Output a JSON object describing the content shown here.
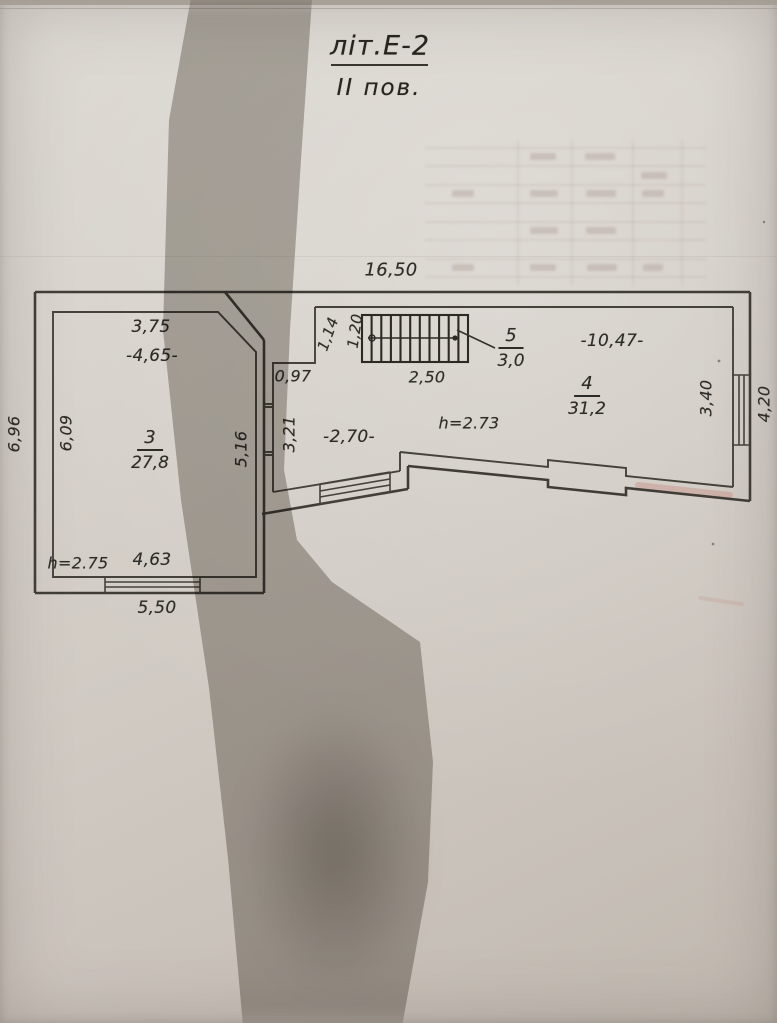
{
  "title": {
    "building_label": "літ.Е-2",
    "floor_label": "ІІ пов."
  },
  "plan": {
    "rooms": [
      {
        "number": "3",
        "area": "27,8",
        "height": "h=2.75"
      },
      {
        "number": "4",
        "area": "31,2",
        "height": "h=2.73"
      },
      {
        "number": "5",
        "area": "3,0"
      }
    ],
    "dims": {
      "total_width": "16,50",
      "room3_top": "3,75",
      "room3_top_inner": "-4,65-",
      "left_outer": "6,96",
      "left_inner": "6,09",
      "room3_right": "5,16",
      "corridor_left": "3,21",
      "corridor_step": "0,97",
      "stair_step": "1,14",
      "stair_width": "1,20",
      "stair_length": "2,50",
      "corridor_width": "-2,70-",
      "room4_length": "-10,47-",
      "room4_right": "3,40",
      "right_outer": "4,20",
      "room3_window": "4,63",
      "room3_bottom": "5,50"
    }
  }
}
